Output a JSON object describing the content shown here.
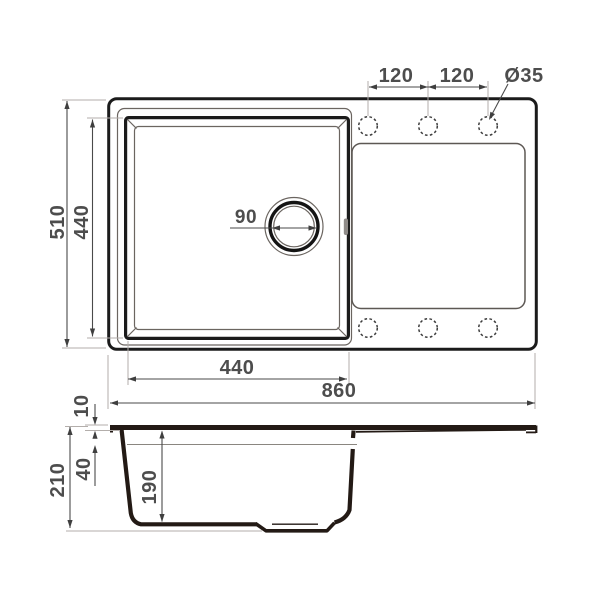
{
  "title": "sink-technical-drawing",
  "top_view": {
    "overall_width_label": "860",
    "overall_depth_label": "510",
    "bowl_width_label": "440",
    "bowl_depth_label": "440",
    "drain_diameter_label": "90",
    "hole_spacing_label_1": "120",
    "hole_spacing_label_2": "120",
    "hole_diameter_label": "Ø35"
  },
  "side_view": {
    "total_height_label": "210",
    "rim_thickness_label": "10",
    "upper_depth_label": "40",
    "bowl_depth_label": "190"
  },
  "colors": {
    "line": "#1b1b1b",
    "profile_line": "#231a15",
    "dimension_line": "#4a4a4a",
    "extension_line": "#b3aeab",
    "text": "#4d4d4d",
    "background": "#ffffff"
  }
}
